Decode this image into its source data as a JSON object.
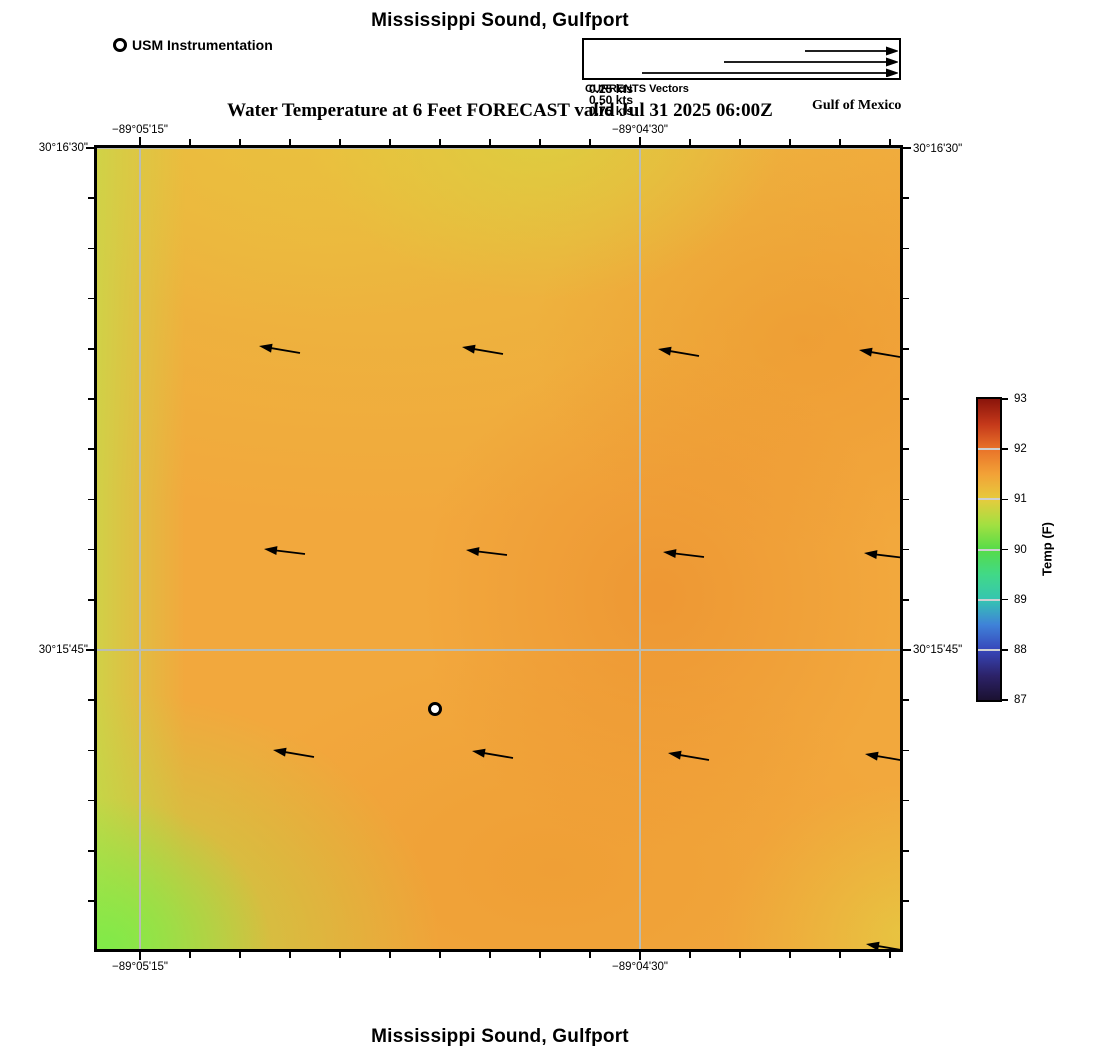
{
  "figure": {
    "top_title": "Mississippi Sound, Gulfport",
    "bottom_title": "Mississippi Sound, Gulfport",
    "subtitle": "Water Temperature at 6 Feet FORECAST valid Jul 31 2025 06:00Z",
    "region_label": "Gulf of Mexico",
    "currents_caption": "CURRENTS Vectors",
    "station_legend_label": "USM Instrumentation"
  },
  "chart_data": {
    "type": "heatmap",
    "title": "Mississippi Sound, Gulfport",
    "subtitle": "Water Temperature at 6 Feet FORECAST valid Jul 31 2025 06:00Z",
    "variable": "Water Temperature at 6 Feet",
    "forecast_valid": "Jul 31 2025 06:00Z",
    "region": "Gulf of Mexico",
    "x_axis": {
      "type": "longitude",
      "ticks": [
        {
          "label": "−89°05'15\"",
          "px": 140
        },
        {
          "label": "−89°04'30\"",
          "px": 640
        }
      ],
      "minor_tick_spacing_px": 50,
      "minor_tick_start_px": 140,
      "range_px": [
        97,
        900
      ]
    },
    "y_axis": {
      "type": "latitude",
      "ticks": [
        {
          "label": "30°16'30\"",
          "px": 148
        },
        {
          "label": "30°15'45\"",
          "px": 650
        }
      ],
      "minor_tick_spacing_px": 50.2,
      "minor_tick_start_px": 148,
      "range_px": [
        148,
        949
      ]
    },
    "map_px": {
      "x": 97,
      "y": 148,
      "w": 803,
      "h": 801
    },
    "gridline_color": "#b9bdb5",
    "colorbar": {
      "label": "Temp (F)",
      "min": 87,
      "max": 93,
      "tick_values": [
        93,
        92,
        91,
        90,
        89,
        88,
        87
      ],
      "px": {
        "x": 978,
        "y": 399,
        "w": 22,
        "h": 301
      },
      "gradient_stops_bottom_to_top": [
        [
          "#1b1131",
          0
        ],
        [
          "#2c2268",
          8
        ],
        [
          "#3747bb",
          16.7
        ],
        [
          "#3f82d8",
          25
        ],
        [
          "#36c5b1",
          33.3
        ],
        [
          "#41d987",
          41.7
        ],
        [
          "#56dc48",
          50
        ],
        [
          "#a3e041",
          58.3
        ],
        [
          "#e6cb3d",
          66.7
        ],
        [
          "#f2a237",
          75
        ],
        [
          "#e97329",
          83.3
        ],
        [
          "#c4381a",
          91.7
        ],
        [
          "#8a140b",
          100
        ]
      ],
      "crossline_values": [
        92,
        91,
        90,
        89,
        88
      ]
    },
    "currents_legend": {
      "caption": "CURRENTS Vectors",
      "box_px": {
        "x": 582,
        "y": 38,
        "w": 319,
        "h": 42
      },
      "items": [
        {
          "label": "0.25 kts",
          "tail_px": 803,
          "tip_px": 897,
          "y_px": 49
        },
        {
          "label": "0.50 kts",
          "tail_px": 722,
          "tip_px": 897,
          "y_px": 60
        },
        {
          "label": "0.75 kts",
          "tail_px": 640,
          "tip_px": 897,
          "y_px": 71
        }
      ]
    },
    "vectors_px": [
      [
        259,
        346,
        300,
        353
      ],
      [
        462,
        347,
        503,
        354
      ],
      [
        658,
        349,
        699,
        356
      ],
      [
        859,
        350,
        900,
        357
      ],
      [
        264,
        549,
        305,
        554
      ],
      [
        466,
        550,
        507,
        555
      ],
      [
        663,
        552,
        704,
        557
      ],
      [
        864,
        553,
        905,
        558
      ],
      [
        273,
        750,
        314,
        757
      ],
      [
        472,
        751,
        513,
        758
      ],
      [
        668,
        753,
        709,
        760
      ],
      [
        865,
        754,
        906,
        761
      ],
      [
        866,
        944,
        907,
        951
      ]
    ],
    "station": {
      "name": "USM Instrumentation",
      "px": [
        435,
        709
      ]
    },
    "temperature_estimate_F": {
      "note": "approximate values read from color field; no numeric labels on map itself",
      "grid_west_to_east_north_to_south": [
        [
          90.7,
          91.0,
          90.8,
          91.3,
          91.3
        ],
        [
          90.6,
          91.2,
          91.2,
          91.5,
          91.4
        ],
        [
          90.6,
          91.2,
          91.3,
          91.6,
          91.3
        ],
        [
          90.4,
          91.3,
          91.2,
          91.4,
          91.2
        ],
        [
          89.9,
          90.7,
          91.1,
          91.3,
          90.9
        ]
      ]
    }
  }
}
